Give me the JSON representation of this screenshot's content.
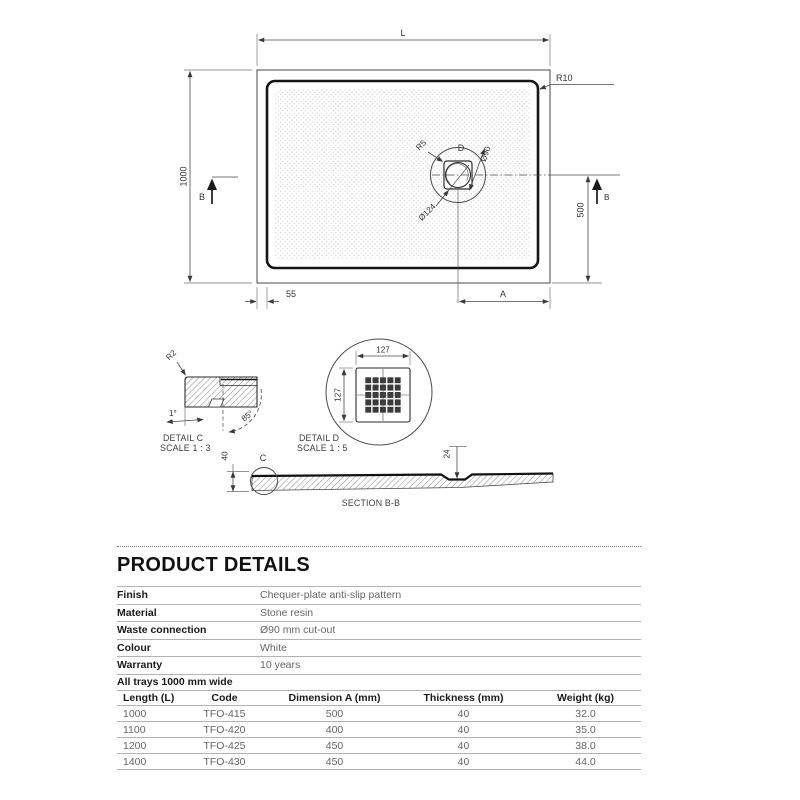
{
  "drawing": {
    "plan_view": {
      "length_label": "L",
      "width_label": "1000",
      "corner_radius_label": "R10",
      "section_arrow_left": "B",
      "section_arrow_right": "B",
      "drain_detail_label": "D",
      "drain_corner_radius": "R5",
      "drain_cutout_diameter": "Ø90",
      "drain_flange_diameter": "Ø124",
      "edge_offset_label": "55",
      "dimension_a_label": "A",
      "center_offset_label": "500"
    },
    "detail_c": {
      "name": "DETAIL C",
      "scale": "SCALE 1 : 3",
      "radius_label": "R2",
      "slope_label": "1°",
      "angle_label": "85°"
    },
    "detail_d": {
      "name": "DETAIL D",
      "scale": "SCALE 1 : 5",
      "width_label": "127",
      "height_label": "127"
    },
    "section_bb": {
      "name": "SECTION B-B",
      "detail_c_marker": "C",
      "edge_thickness_label": "40",
      "waste_depth_label": "24"
    }
  },
  "product_details": {
    "title": "PRODUCT DETAILS",
    "specs": [
      {
        "label": "Finish",
        "value": "Chequer-plate anti-slip pattern"
      },
      {
        "label": "Material",
        "value": "Stone resin"
      },
      {
        "label": "Waste connection",
        "value": "Ø90 mm cut-out"
      },
      {
        "label": "Colour",
        "value": "White"
      },
      {
        "label": "Warranty",
        "value": "10 years"
      }
    ],
    "note": "All trays 1000 mm wide",
    "size_table": {
      "headers": [
        "Length (L)",
        "Code",
        "Dimension A (mm)",
        "Thickness (mm)",
        "Weight (kg)"
      ],
      "rows": [
        [
          "1000",
          "TFO-415",
          "500",
          "40",
          "32.0"
        ],
        [
          "1100",
          "TFO-420",
          "400",
          "40",
          "35.0"
        ],
        [
          "1200",
          "TFO-425",
          "450",
          "40",
          "38.0"
        ],
        [
          "1400",
          "TFO-430",
          "450",
          "40",
          "44.0"
        ]
      ]
    }
  },
  "colors": {
    "line_dark": "#2a2a2a",
    "line_dim": "#4a4a4a",
    "table_rule": "#b3b3b3",
    "text_secondary": "#666666"
  }
}
